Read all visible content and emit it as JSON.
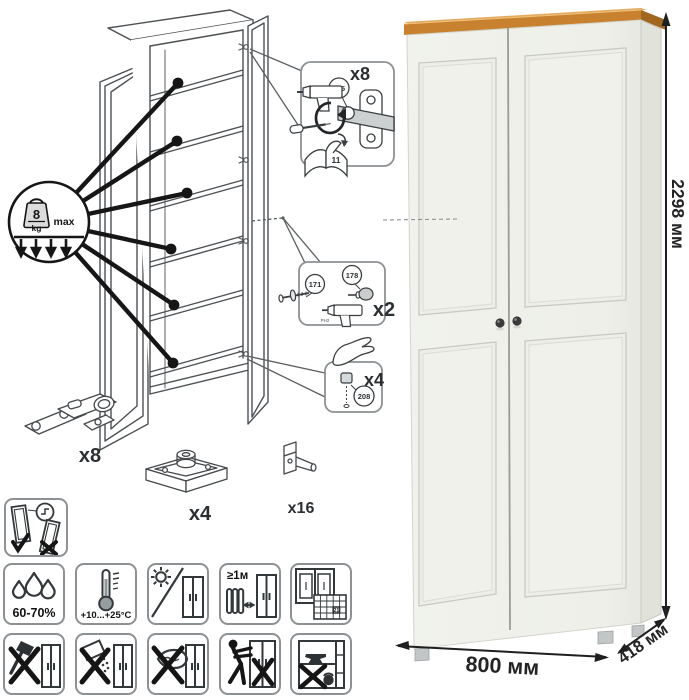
{
  "product": {
    "dim_height": "2298 мм",
    "dim_width": "800 мм",
    "dim_depth": "418 мм"
  },
  "assembly": {
    "shelf_load": {
      "value": "8",
      "unit": "kg",
      "qualifier": "max"
    },
    "hinge_step": {
      "qty": "x8",
      "part": "115",
      "manual_page": "11"
    },
    "knob_step": {
      "qty": "x2",
      "part_screw": "171",
      "part_knob": "178",
      "bit": "PH2"
    },
    "cap_step": {
      "qty": "x4",
      "part": "208"
    },
    "hardware": {
      "hinge_qty": "x8",
      "foot_qty": "x4",
      "shelf_pin_qty": "x16"
    }
  },
  "care": {
    "humidity": "60-70%",
    "temperature": "+10...+25°С",
    "min_distance": "≥1м",
    "calendar_day": "21"
  },
  "colors": {
    "line_art": "#4d5154",
    "annotation_black": "#161616",
    "pictogram_border": "#8d9193",
    "wood_top": "#c8822f",
    "body_white": "#eef0e9",
    "side_shade": "#e1e3da",
    "dimension_text": "#242424"
  }
}
